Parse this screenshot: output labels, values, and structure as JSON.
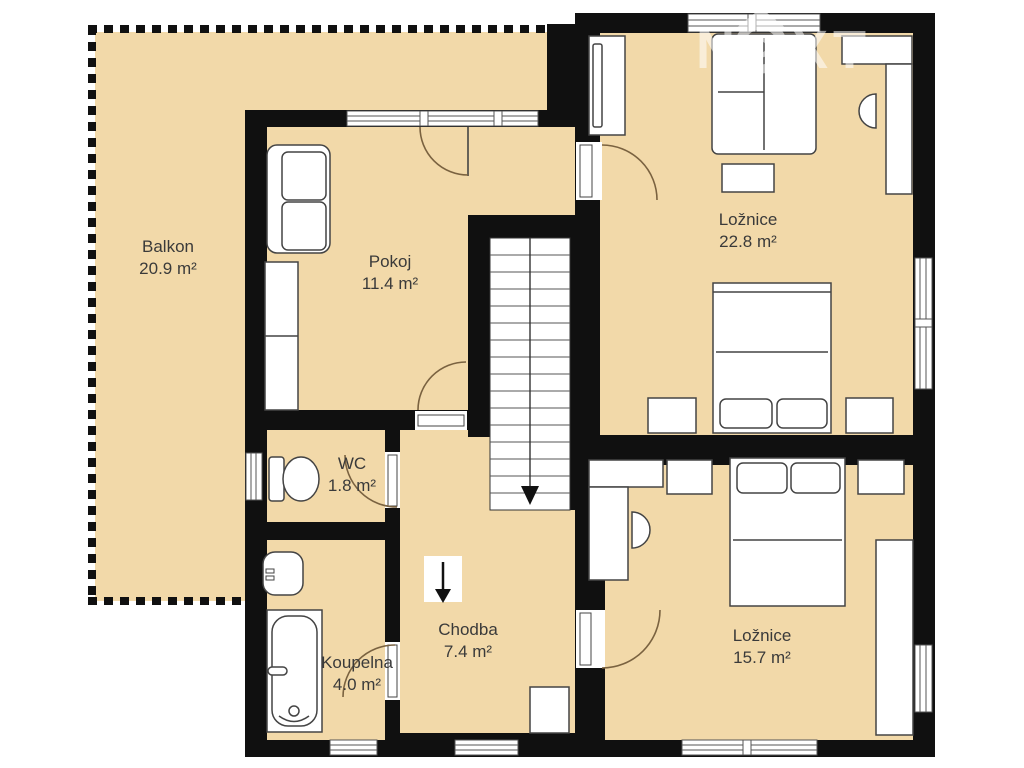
{
  "watermark": {
    "letter_n": "N",
    "letters_xt": "XT"
  },
  "rooms": [
    {
      "name": "Balkon",
      "area": "20.9 m²"
    },
    {
      "name": "Pokoj",
      "area": "11.4 m²"
    },
    {
      "name": "Ložnice",
      "area": "22.8 m²"
    },
    {
      "name": "WC",
      "area": "1.8 m²"
    },
    {
      "name": "Koupelna",
      "area": "4.0 m²"
    },
    {
      "name": "Chodba",
      "area": "7.4 m²"
    },
    {
      "name": "Ložnice",
      "area": "15.7 m²"
    }
  ],
  "icons": {
    "stairs_direction": "down-arrow",
    "hall_direction": "down-arrow"
  },
  "colors": {
    "floor": "#f2d9a9",
    "wall": "#101010",
    "door_arc": "#7a6240",
    "furniture_stroke": "#444444",
    "watermark": "rgba(255,255,255,0.55)"
  }
}
